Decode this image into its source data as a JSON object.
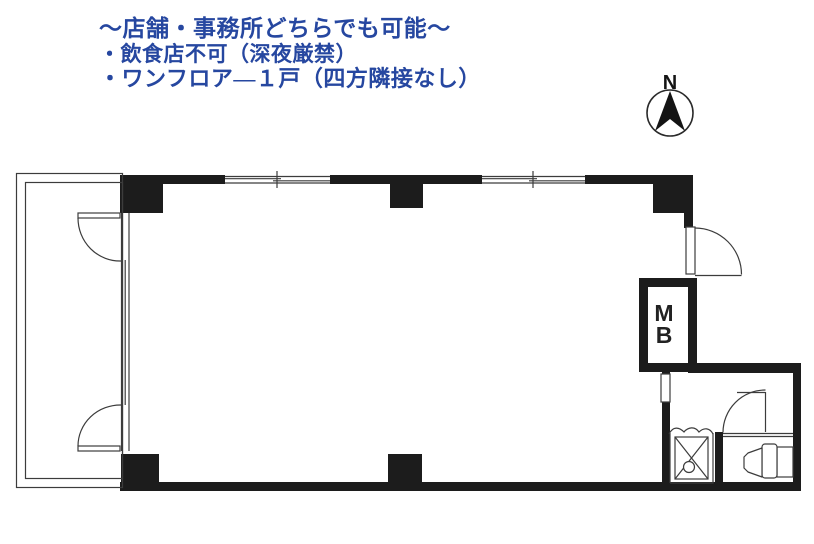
{
  "notes": {
    "line1": "〜店舗・事務所どちらでも可能〜",
    "line2": "・飲食店不可（深夜厳禁）",
    "line3": "・ワンフロア―１戸（四方隣接なし）"
  },
  "compass": {
    "label": "N"
  },
  "floorplan": {
    "meter_box": {
      "line1": "M",
      "line2": "B"
    }
  },
  "colors": {
    "annotation_text": "#2647a0",
    "wall": "#1c1c1c",
    "line": "#3c3c3c",
    "compass": "#141414"
  }
}
